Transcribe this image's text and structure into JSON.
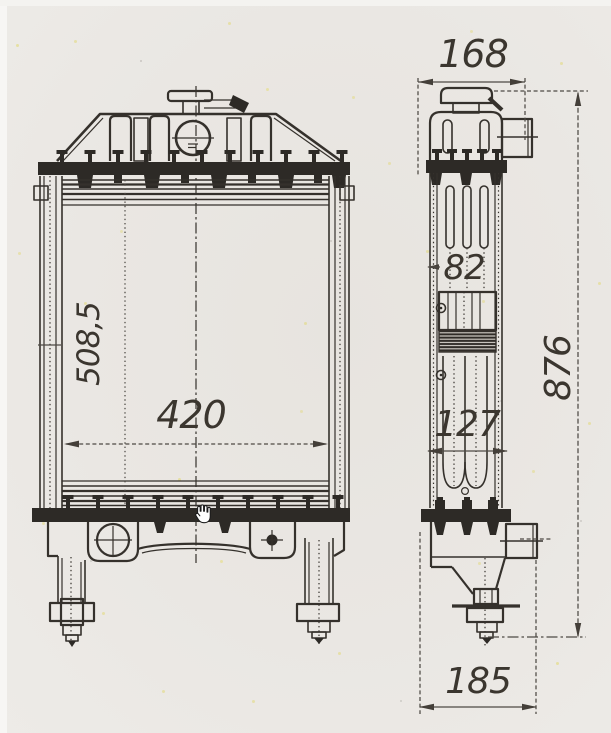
{
  "surface": {
    "kind": "scanned engineering drawing of a tractor radiator, two orthographic views",
    "paper_color": "#eae7e3",
    "ink_color": "#35312c"
  },
  "dimensions": {
    "front_height": "508,5",
    "front_width": "420",
    "side_top_width": "168",
    "side_core_width": "82",
    "side_lower_width": "127",
    "side_overall_height": "876",
    "side_bottom_width": "185"
  },
  "cursor": {
    "icon": "hand-grab"
  }
}
